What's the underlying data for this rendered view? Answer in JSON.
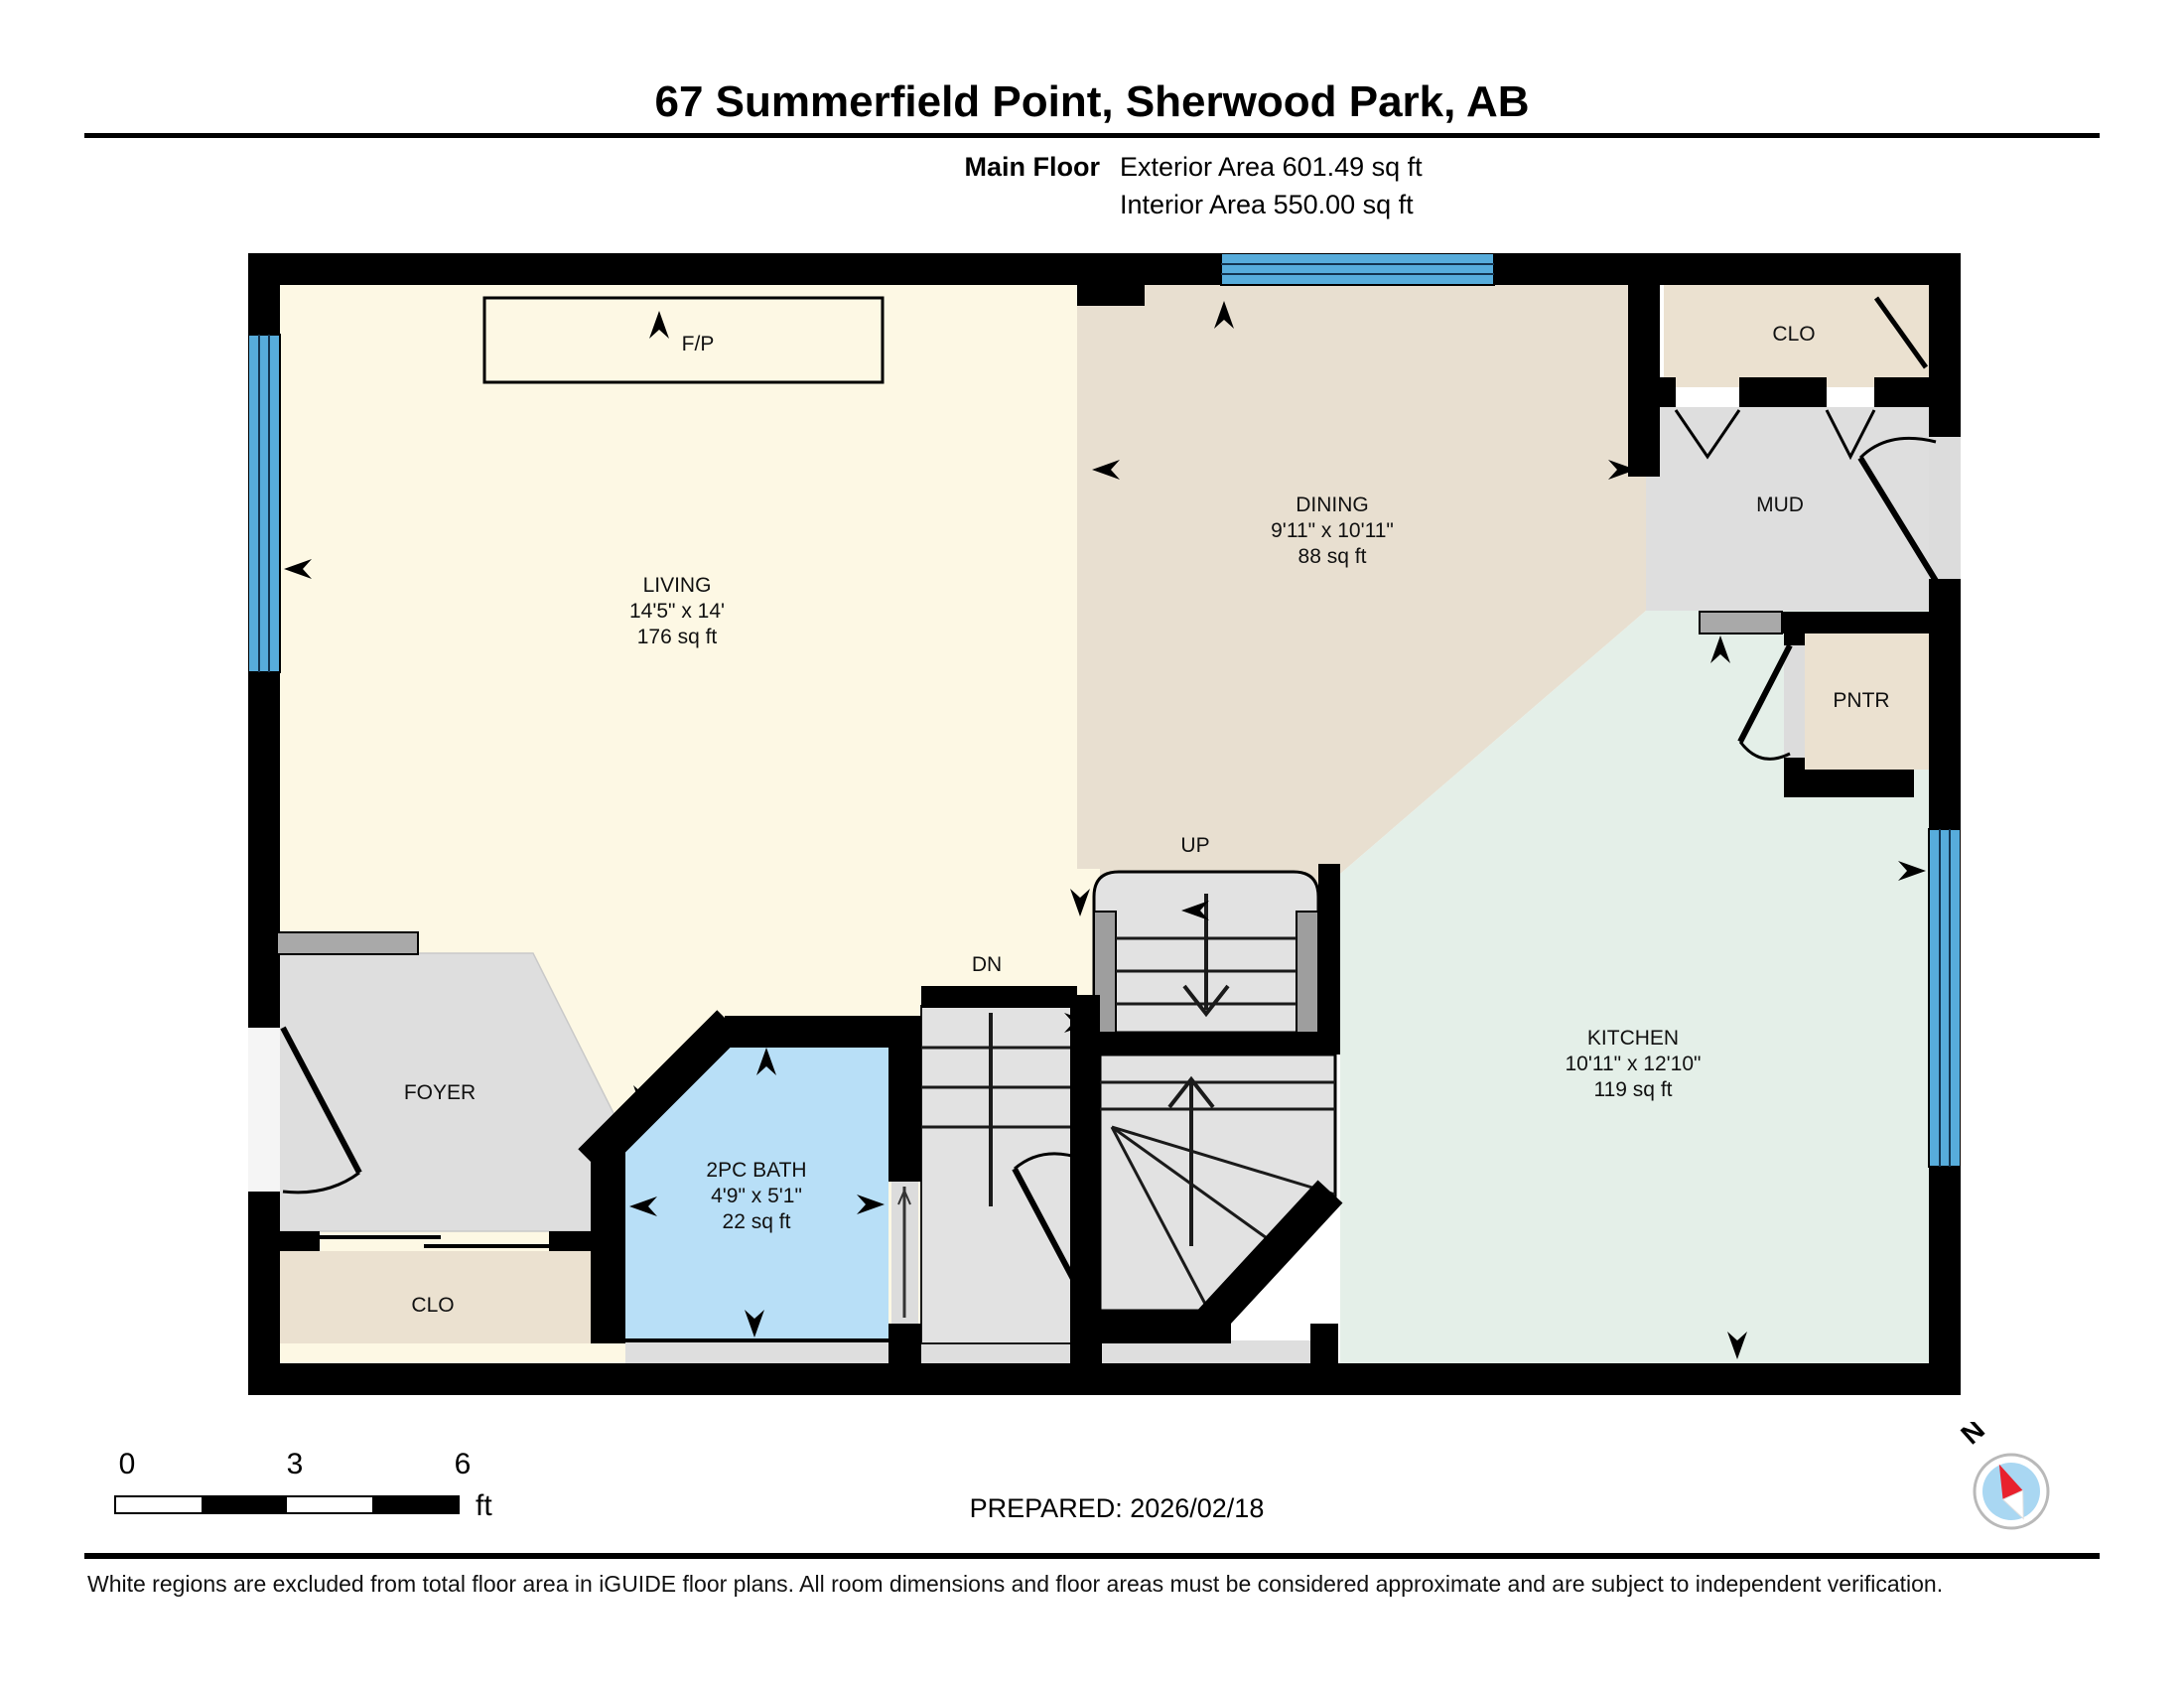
{
  "header": {
    "title": "67 Summerfield Point, Sherwood Park, AB",
    "floor_label": "Main Floor",
    "exterior_area": "Exterior Area 601.49 sq ft",
    "interior_area": "Interior Area 550.00 sq ft"
  },
  "rooms": {
    "living": {
      "name": "LIVING",
      "dims": "14'5\" x 14'",
      "area": "176 sq ft"
    },
    "dining": {
      "name": "DINING",
      "dims": "9'11\" x 10'11\"",
      "area": "88 sq ft"
    },
    "kitchen": {
      "name": "KITCHEN",
      "dims": "10'11\" x 12'10\"",
      "area": "119 sq ft"
    },
    "bath": {
      "name": "2PC BATH",
      "dims": "4'9\" x 5'1\"",
      "area": "22 sq ft"
    },
    "foyer": {
      "name": "FOYER"
    },
    "closet_main": {
      "name": "CLO"
    },
    "closet_mud": {
      "name": "CLO"
    },
    "mud": {
      "name": "MUD"
    },
    "pantry": {
      "name": "PNTR"
    }
  },
  "labels": {
    "up": "UP",
    "down": "DN",
    "fireplace": "F/P",
    "compass_north": "N"
  },
  "scale_bar": {
    "start": "0",
    "mid": "3",
    "end": "6",
    "unit": "ft"
  },
  "footer": {
    "prepared": "PREPARED: 2026/02/18",
    "disclaimer": "White regions are excluded from total floor area in iGUIDE floor plans. All room dimensions and floor areas must be considered approximate and are subject to independent verification."
  },
  "colors": {
    "wall": "#000000",
    "window": "#57ACDB",
    "living": "#FDF8E4",
    "dining": "#E8DFD0",
    "kitchen": "#E4EFE8",
    "bath": "#B8DFF7",
    "floor": "#DEDEDE",
    "closet": "#EBE1D0",
    "stair": "#E2E2E2",
    "rail": "#9E9E9E",
    "counter": "#A9A9A9",
    "opening": "#DCDCDC",
    "compass_red": "#E8212D",
    "compass_blue": "#A9D7F2"
  }
}
